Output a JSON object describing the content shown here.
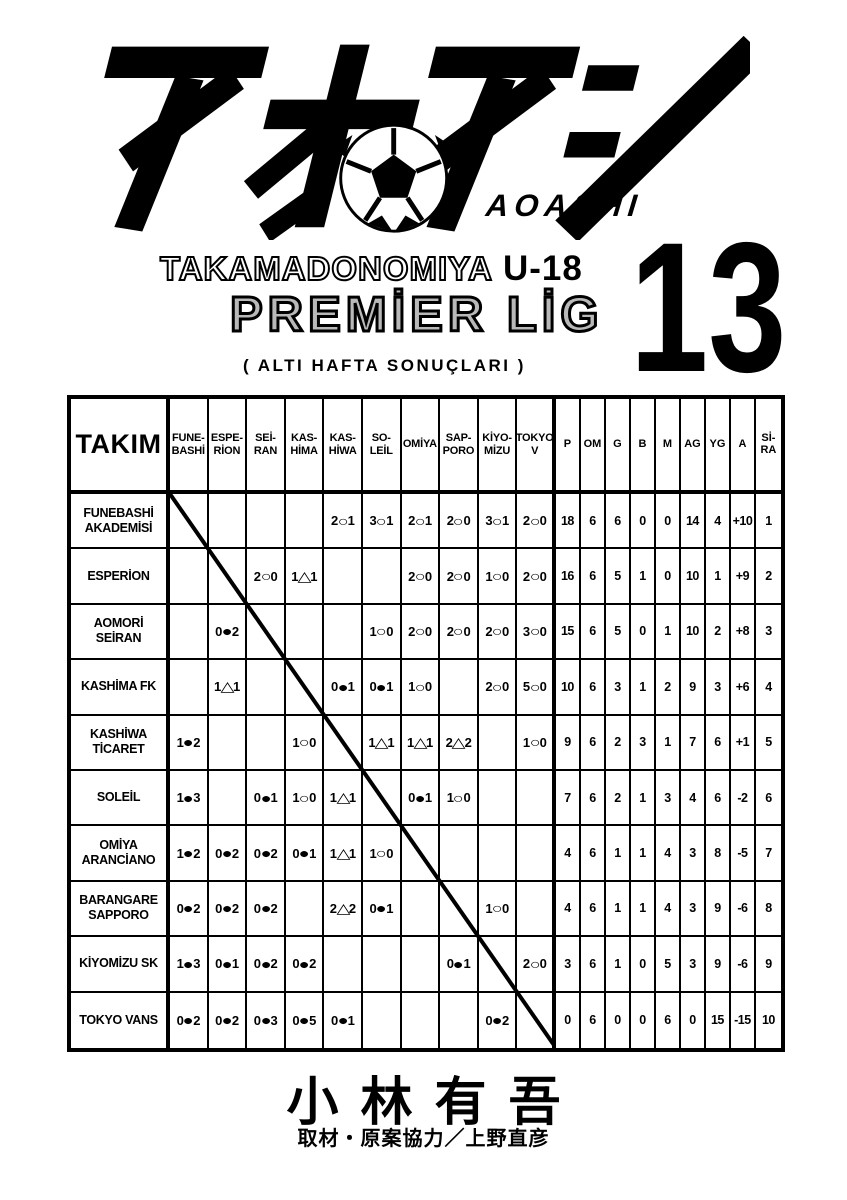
{
  "page": {
    "background": "#ffffff",
    "ink": "#000000",
    "league_gray": "#b9b9b9"
  },
  "logo": {
    "title_kana": "アオアシ",
    "romaji": "AOASHI",
    "ball_icon": "soccer-ball-icon"
  },
  "title": {
    "series": "TAKAMADONOMIYA",
    "division": "U-18",
    "league": "PREMİER LİG",
    "note": "( ALTI HAFTA SONUÇLARI )",
    "volume": "13"
  },
  "table": {
    "corner_header": "TAKIM",
    "opponent_headers": [
      "FUNE-\nBASHİ",
      "ESPE-\nRİON",
      "SEİ-\nRAN",
      "KAS-\nHİMA",
      "KAS-\nHİWA",
      "SO-\nLEİL",
      "OMİYA",
      "SAP-\nPORO",
      "KİYO-\nMİZU",
      "TOKYO\nV"
    ],
    "stat_headers": [
      "P",
      "OM",
      "G",
      "B",
      "M",
      "AG",
      "YG",
      "A",
      "Sİ-\nRA"
    ],
    "legend": {
      "win_symbol": "○",
      "loss_symbol": "●",
      "draw_symbol": "△"
    },
    "rows": [
      {
        "team": "FUNEBASHİ\nAKADEMİSİ",
        "results": [
          null,
          "",
          "",
          "",
          "2○1",
          "3○1",
          "2○1",
          "2○0",
          "3○1",
          "2○0"
        ],
        "stats": [
          "18",
          "6",
          "6",
          "0",
          "0",
          "14",
          "4",
          "+10",
          "1"
        ]
      },
      {
        "team": "ESPERİON",
        "results": [
          "",
          null,
          "2○0",
          "1△1",
          "",
          "",
          "2○0",
          "2○0",
          "1○0",
          "2○0"
        ],
        "stats": [
          "16",
          "6",
          "5",
          "1",
          "0",
          "10",
          "1",
          "+9",
          "2"
        ]
      },
      {
        "team": "AOMORİ\nSEİRAN",
        "results": [
          "",
          "0●2",
          null,
          "",
          "",
          "1○0",
          "2○0",
          "2○0",
          "2○0",
          "3○0"
        ],
        "stats": [
          "15",
          "6",
          "5",
          "0",
          "1",
          "10",
          "2",
          "+8",
          "3"
        ]
      },
      {
        "team": "KASHİMA FK",
        "results": [
          "",
          "1△1",
          "",
          null,
          "0●1",
          "0●1",
          "1○0",
          "",
          "2○0",
          "5○0"
        ],
        "stats": [
          "10",
          "6",
          "3",
          "1",
          "2",
          "9",
          "3",
          "+6",
          "4"
        ]
      },
      {
        "team": "KASHİWA\nTİCARET",
        "results": [
          "1●2",
          "",
          "",
          "1○0",
          null,
          "1△1",
          "1△1",
          "2△2",
          "",
          "1○0"
        ],
        "stats": [
          "9",
          "6",
          "2",
          "3",
          "1",
          "7",
          "6",
          "+1",
          "5"
        ]
      },
      {
        "team": "SOLEİL",
        "results": [
          "1●3",
          "",
          "0●1",
          "1○0",
          "1△1",
          null,
          "0●1",
          "1○0",
          "",
          ""
        ],
        "stats": [
          "7",
          "6",
          "2",
          "1",
          "3",
          "4",
          "6",
          "-2",
          "6"
        ]
      },
      {
        "team": "OMİYA\nARANCİANO",
        "results": [
          "1●2",
          "0●2",
          "0●2",
          "0●1",
          "1△1",
          "1○0",
          null,
          "",
          "",
          ""
        ],
        "stats": [
          "4",
          "6",
          "1",
          "1",
          "4",
          "3",
          "8",
          "-5",
          "7"
        ]
      },
      {
        "team": "BARANGARE\nSAPPORO",
        "results": [
          "0●2",
          "0●2",
          "0●2",
          "",
          "2△2",
          "0●1",
          "",
          null,
          "1○0",
          ""
        ],
        "stats": [
          "4",
          "6",
          "1",
          "1",
          "4",
          "3",
          "9",
          "-6",
          "8"
        ]
      },
      {
        "team": "KİYOMİZU SK",
        "results": [
          "1●3",
          "0●1",
          "0●2",
          "0●2",
          "",
          "",
          "",
          "0●1",
          null,
          "2○0"
        ],
        "stats": [
          "3",
          "6",
          "1",
          "0",
          "5",
          "3",
          "9",
          "-6",
          "9"
        ]
      },
      {
        "team": "TOKYO VANS",
        "results": [
          "0●2",
          "0●2",
          "0●3",
          "0●5",
          "0●1",
          "",
          "",
          "",
          "0●2",
          null
        ],
        "stats": [
          "0",
          "6",
          "0",
          "0",
          "6",
          "0",
          "15",
          "-15",
          "10"
        ]
      }
    ]
  },
  "footer": {
    "author": "小林有吾",
    "credit": "取材・原案協力／上野直彦"
  }
}
